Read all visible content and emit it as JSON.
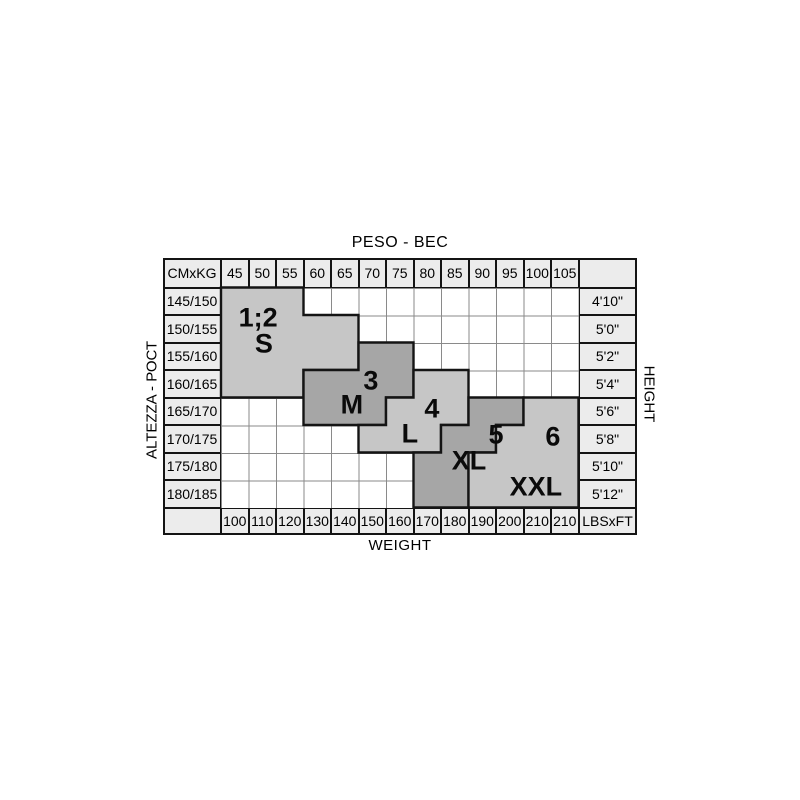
{
  "colors": {
    "light_region": "#c6c6c6",
    "dark_region": "#a6a6a6",
    "label_cell": "#ececec",
    "grid_line": "#8a8a8a",
    "border": "#141414",
    "text": "#000000"
  },
  "chart_data": {
    "type": "table",
    "title_top": "PESO - ВЕС",
    "axis_left": "ALTEZZA - РОСТ",
    "axis_right": "HEIGHT",
    "title_bottom": "WEIGHT",
    "corner_top_left": "CMxKG",
    "corner_bottom_right": "LBSxFT",
    "weights_kg": [
      "45",
      "50",
      "55",
      "60",
      "65",
      "70",
      "75",
      "80",
      "85",
      "90",
      "95",
      "100",
      "105"
    ],
    "weights_lbs": [
      "100",
      "110",
      "120",
      "130",
      "140",
      "150",
      "160",
      "170",
      "180",
      "190",
      "200",
      "210",
      "210"
    ],
    "heights_cm": [
      "145/150",
      "150/155",
      "155/160",
      "160/165",
      "165/170",
      "170/175",
      "175/180",
      "180/185"
    ],
    "heights_ft": [
      "4'10\"",
      "5'0\"",
      "5'2\"",
      "5'4\"",
      "5'6\"",
      "5'8\"",
      "5'10\"",
      "5'12\""
    ],
    "sizes": [
      {
        "number": "1;2",
        "label": "S",
        "shade": "light",
        "cells": [
          {
            "row": 0,
            "cols": [
              0,
              2
            ]
          },
          {
            "row": 1,
            "cols": [
              0,
              4
            ]
          },
          {
            "row": 2,
            "cols": [
              0,
              4
            ]
          },
          {
            "row": 3,
            "cols": [
              0,
              2
            ]
          }
        ],
        "number_anchor": {
          "col": 1.35,
          "row": 1.11
        },
        "label_anchor": {
          "col": 1.56,
          "row": 2.05
        }
      },
      {
        "number": "3",
        "label": "M",
        "shade": "dark",
        "cells": [
          {
            "row": 2,
            "cols": [
              5,
              6
            ]
          },
          {
            "row": 3,
            "cols": [
              3,
              6
            ]
          },
          {
            "row": 4,
            "cols": [
              3,
              5
            ]
          }
        ],
        "number_anchor": {
          "col": 5.45,
          "row": 3.4
        },
        "label_anchor": {
          "col": 4.76,
          "row": 4.27
        }
      },
      {
        "number": "4",
        "label": "L",
        "shade": "light",
        "cells": [
          {
            "row": 3,
            "cols": [
              7,
              8
            ]
          },
          {
            "row": 4,
            "cols": [
              6,
              8
            ]
          },
          {
            "row": 5,
            "cols": [
              5,
              7
            ]
          }
        ],
        "number_anchor": {
          "col": 7.67,
          "row": 4.42
        },
        "label_anchor": {
          "col": 6.87,
          "row": 5.33
        }
      },
      {
        "number": "5",
        "label": "XL",
        "shade": "dark",
        "cells": [
          {
            "row": 4,
            "cols": [
              9,
              10
            ]
          },
          {
            "row": 5,
            "cols": [
              8,
              9
            ]
          },
          {
            "row": 6,
            "cols": [
              7,
              8
            ]
          },
          {
            "row": 7,
            "cols": [
              7,
              8
            ]
          }
        ],
        "number_anchor": {
          "col": 10.0,
          "row": 5.36
        },
        "label_anchor": {
          "col": 9.02,
          "row": 6.31
        }
      },
      {
        "number": "6",
        "label": "XXL",
        "shade": "light",
        "cells": [
          {
            "row": 4,
            "cols": [
              11,
              12
            ]
          },
          {
            "row": 5,
            "cols": [
              10,
              12
            ]
          },
          {
            "row": 6,
            "cols": [
              9,
              12
            ]
          },
          {
            "row": 7,
            "cols": [
              9,
              12
            ]
          }
        ],
        "number_anchor": {
          "col": 12.07,
          "row": 5.44
        },
        "label_anchor": {
          "col": 11.45,
          "row": 7.25
        }
      }
    ]
  }
}
